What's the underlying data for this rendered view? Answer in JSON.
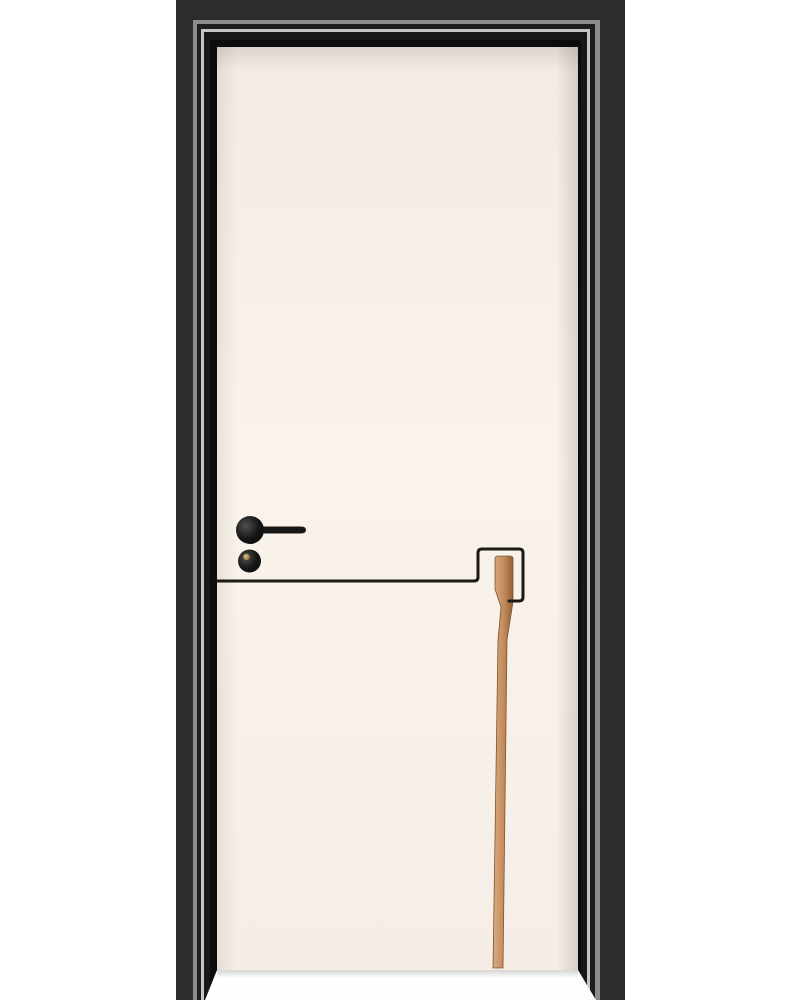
{
  "meta": {
    "subject": "Interior door product photo",
    "alt": "Cream white interior door in a black molded frame, with a black lever handle, round lock knob with brass keyhole, a black inlay groove line and a copper wood inlay strip"
  },
  "palette": {
    "background": "#ffffff",
    "floor": "#fefefe",
    "frame": {
      "outer_band": "#2c2c2c",
      "mid_band": "#1e1e1e",
      "inner_band": "#181818",
      "reveal": "#0c0c0c",
      "highlight_outer": "#8c8c8c",
      "highlight_inner": "#c6c6c6"
    },
    "door_leaf": {
      "top": "#f3ebe3",
      "base": "#faf3ec",
      "bottom": "#f5eee6"
    },
    "inlay": {
      "groove_line": "#1d1916",
      "strip_light": "#dcab82",
      "strip_mid": "#c28a5c",
      "strip_dark": "#8f6138",
      "strip_outline": "#7c5531"
    },
    "hardware": {
      "black": "#161616",
      "sheen": "#505050",
      "keyhole_gold": "#e2c282",
      "keyhole_gold_dark": "#7e5c20"
    }
  },
  "scene": {
    "elements": [
      "black door frame with molded casing and highlight beading",
      "cream door leaf",
      "black lever handle on round rose",
      "round lock knob with brass keyhole",
      "black inlay groove line stepping around inlay strip",
      "copper wood inlay strip running to the floor"
    ]
  }
}
